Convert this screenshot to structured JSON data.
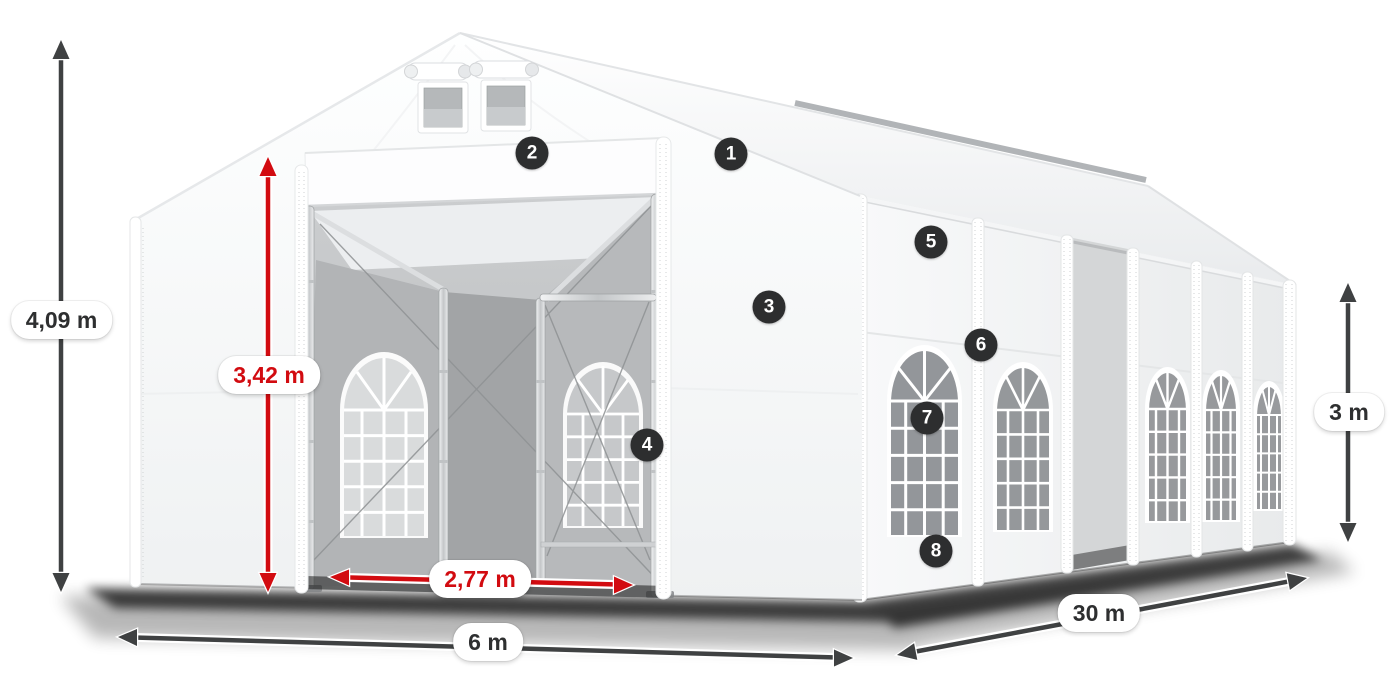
{
  "dimensions": [
    {
      "id": "total-height",
      "label": "4,09 m",
      "color": "#3f4142"
    },
    {
      "id": "entrance-height",
      "label": "3,42 m",
      "color": "#d20b10"
    },
    {
      "id": "entrance-width",
      "label": "2,77 m",
      "color": "#d20b10"
    },
    {
      "id": "front-width",
      "label": "6 m",
      "color": "#3f4142"
    },
    {
      "id": "length",
      "label": "30 m",
      "color": "#3f4142"
    },
    {
      "id": "side-height",
      "label": "3 m",
      "color": "#3f4142"
    }
  ],
  "markers": [
    "1",
    "2",
    "3",
    "4",
    "5",
    "6",
    "7",
    "8"
  ],
  "colors": {
    "dimension_red": "#d20b10",
    "dimension_dark": "#3f4142",
    "marker_bg": "#2d2e2f",
    "marker_text": "#ffffff",
    "label_bg": "#ffffff",
    "label_text": "#2e2f30",
    "canvas_bg": "#ffffff"
  }
}
